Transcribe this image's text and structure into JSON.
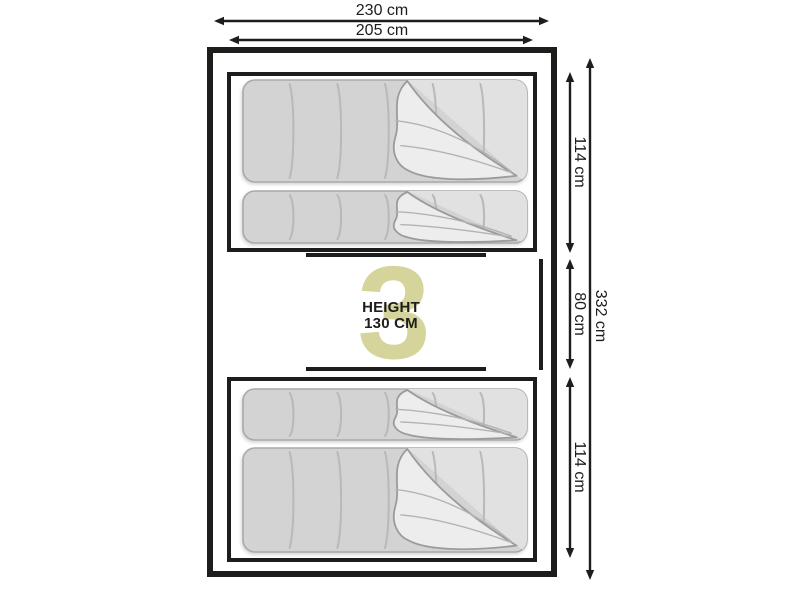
{
  "diagram": {
    "watermark_number": "3",
    "center_label": {
      "line1": "HEIGHT",
      "line2": "130 CM"
    },
    "dimensions": {
      "width_outer": "230 cm",
      "width_inner": "205 cm",
      "section_top": "114 cm",
      "section_middle": "80 cm",
      "section_bottom": "114 cm",
      "height_total": "332 cm"
    }
  },
  "colors": {
    "line": "#1d1d1b",
    "text": "#1d1d1b",
    "watermark": "#d5d49a",
    "background": "#ffffff",
    "bag_fill": "#d3d3d3",
    "bag_outline": "#a9a9a9",
    "bag_seam": "#b9b9b9",
    "bag_inner_fill": "#e1e1e1",
    "fold_fill": "#ededed",
    "fold_stroke": "#9b9b9b",
    "fold_line": "#b3b3b3"
  }
}
